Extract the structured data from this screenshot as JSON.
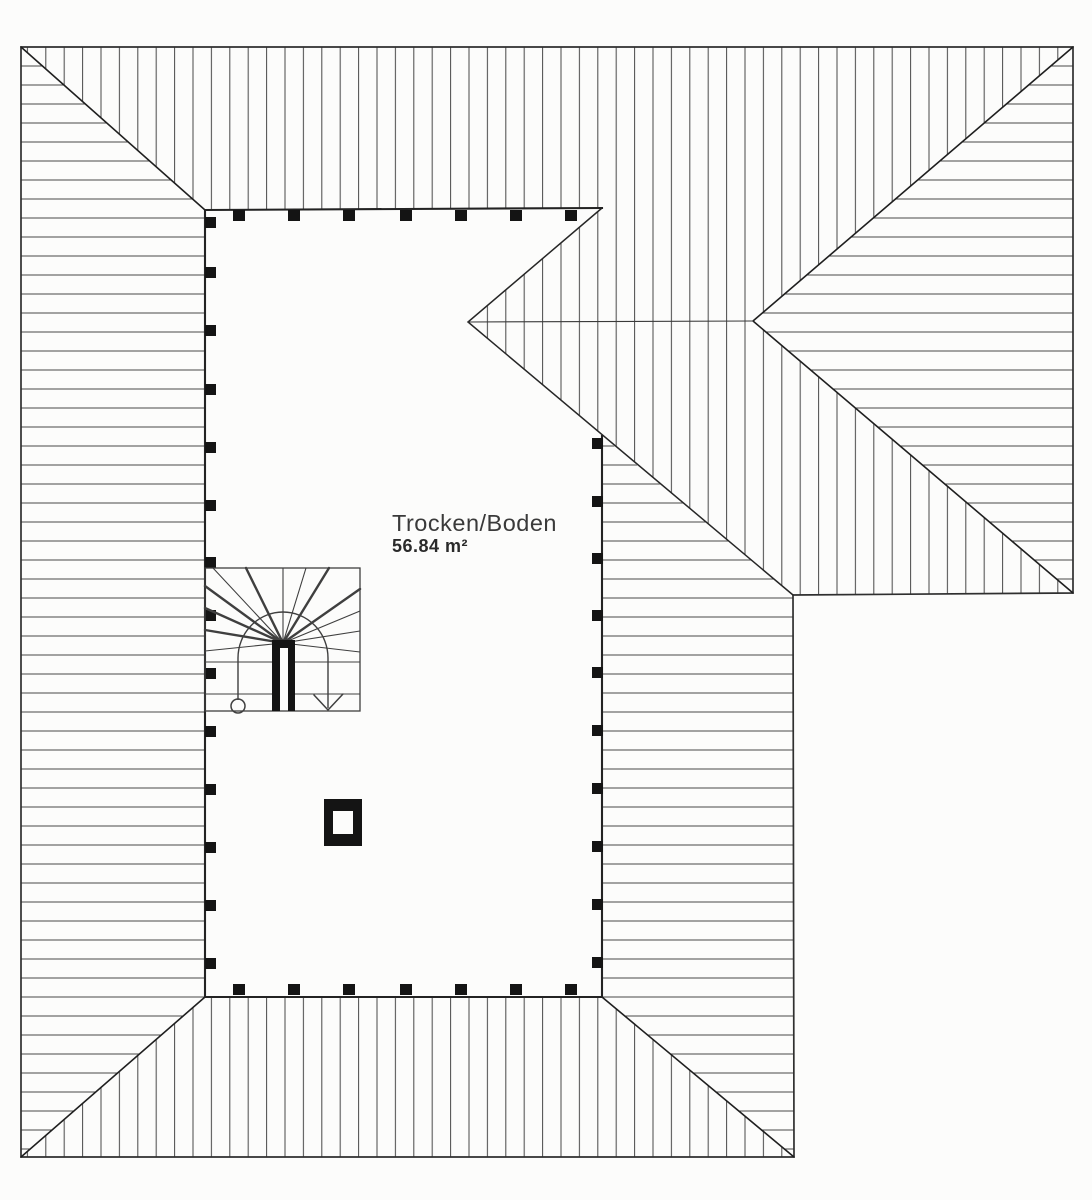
{
  "plan": {
    "room": {
      "name": "Trocken/Boden",
      "area": "56.84 m²"
    }
  },
  "colors": {
    "paper": "#fcfcfb",
    "outline": "#2f2f2f",
    "wall": "#232323",
    "hatch": "#4f4f4f",
    "post": "#141414",
    "detail": "#3f3f3f",
    "label": "#3a3a3a"
  }
}
